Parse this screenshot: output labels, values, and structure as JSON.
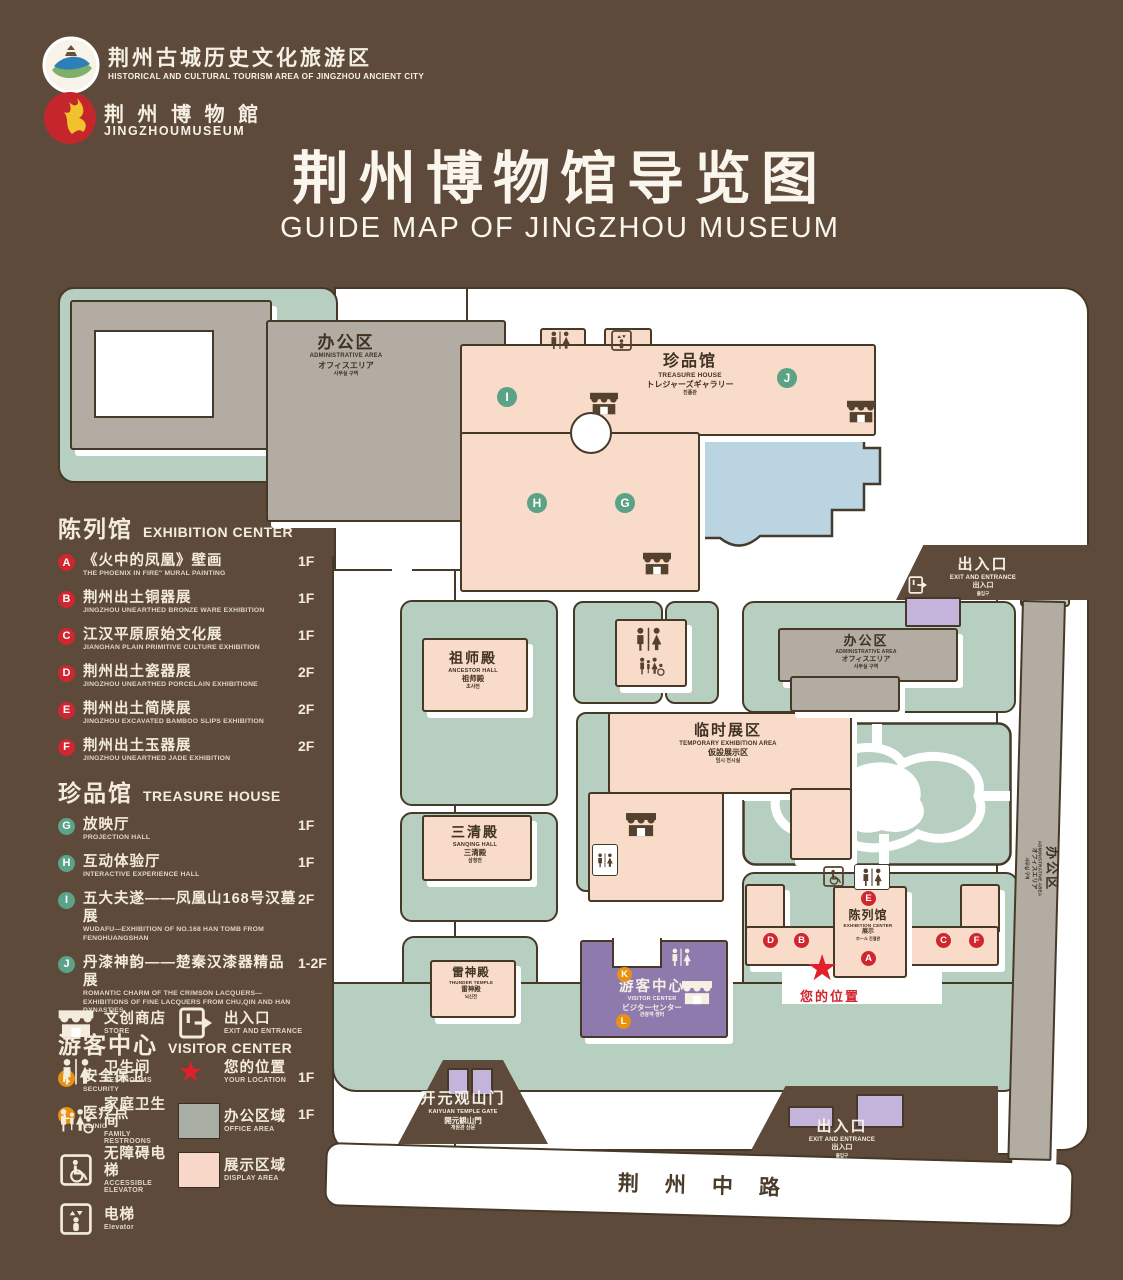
{
  "header": {
    "tourism_logo": {
      "cn": "荆州古城历史文化旅游区",
      "en": "HISTORICAL AND CULTURAL TOURISM AREA OF JINGZHOU ANCIENT CITY"
    },
    "museum_logo": {
      "cn": "荆 州 博 物 館",
      "en": "JINGZHOUMUSEUM"
    },
    "title_cn": "荆州博物馆导览图",
    "title_en": "GUIDE MAP OF JINGZHOU MUSEUM"
  },
  "colors": {
    "background": "#5d4a3a",
    "lawn_green": "#b7cfc1",
    "display_pink": "#f8dbc9",
    "office_gray": "#b2aca3",
    "pond_blue": "#bad4e2",
    "visitor_purple": "#8e7aac",
    "gate_purple": "#c4b3da",
    "badge_red": "#cf2630",
    "badge_green": "#5ba287",
    "badge_orange": "#e89112",
    "star_red": "#e0212b"
  },
  "legend": {
    "sections": [
      {
        "cn": "陈列馆",
        "en": "EXHIBITION CENTER",
        "badge_color": "#cf2630",
        "items": [
          {
            "key": "A",
            "cn": "《火中的凤凰》壁画",
            "en": "THE PHOENIX IN FIRE\" MURAL PAINTING",
            "floor": "1F"
          },
          {
            "key": "B",
            "cn": "荆州出土铜器展",
            "en": "JINGZHOU UNEARTHED BRONZE WARE EXHIBITION",
            "floor": "1F"
          },
          {
            "key": "C",
            "cn": "江汉平原原始文化展",
            "en": "JIANGHAN PLAIN PRIMITIVE CULTURE EXHIBITION",
            "floor": "1F"
          },
          {
            "key": "D",
            "cn": "荆州出土瓷器展",
            "en": "JINGZHOU UNEARTHED PORCELAIN EXHIBITIONE",
            "floor": "2F"
          },
          {
            "key": "E",
            "cn": "荆州出土简牍展",
            "en": "JINGZHOU EXCAVATED BAMBOO SLIPS EXHIBITION",
            "floor": "2F"
          },
          {
            "key": "F",
            "cn": "荆州出土玉器展",
            "en": "JINGZHOU UNEARTHED JADE EXHIBITION",
            "floor": "2F"
          }
        ]
      },
      {
        "cn": "珍品馆",
        "en": "TREASURE HOUSE",
        "badge_color": "#5ba287",
        "items": [
          {
            "key": "G",
            "cn": "放映厅",
            "en": "PROJECTION HALL",
            "floor": "1F"
          },
          {
            "key": "H",
            "cn": "互动体验厅",
            "en": "INTERACTIVE EXPERIENCE HALL",
            "floor": "1F"
          },
          {
            "key": "I",
            "cn": "五大夫遂——凤凰山168号汉墓展",
            "en": "WUDAFU—EXHIBITION OF NO.168 HAN TOMB FROM FENGHUANGSHAN",
            "floor": "2F"
          },
          {
            "key": "J",
            "cn": "丹漆神韵——楚秦汉漆器精品展",
            "en": "ROMANTIC CHARM OF THE CRIMSON LACQUERS—EXHIBITIONS OF FINE LACQUERS FROM CHU,QIN AND HAN DYNASTIES",
            "floor": "1-2F"
          }
        ]
      },
      {
        "cn": "游客中心",
        "en": "VISITOR CENTER",
        "badge_color": "#e89112",
        "items": [
          {
            "key": "K",
            "cn": "安全保卫",
            "en": "SECURITY",
            "floor": "1F"
          },
          {
            "key": "L",
            "cn": "医疗点",
            "en": "CLINIC",
            "floor": "1F"
          }
        ]
      }
    ],
    "symbols": [
      {
        "kind": "shop",
        "name": "store-icon",
        "cn": "文创商店",
        "en": "STORE"
      },
      {
        "kind": "wc",
        "name": "restrooms-icon",
        "cn": "卫生间",
        "en": "RESTROOMS"
      },
      {
        "kind": "family",
        "name": "family-restroom-icon",
        "cn": "家庭卫生间",
        "en": "FAMILY RESTROONS"
      },
      {
        "kind": "acc",
        "name": "accessible-elevator-icon",
        "cn": "无障碍电梯",
        "en": "ACCESSIBLE  ELEVATOR"
      },
      {
        "kind": "elev",
        "name": "elevator-icon",
        "cn": "电梯",
        "en": "Elevator"
      },
      {
        "kind": "exit",
        "name": "exit-entrance-icon",
        "cn": "出入口",
        "en": "EXIT AND ENTRANCE"
      },
      {
        "kind": "star",
        "name": "your-location-icon",
        "cn": "您的位置",
        "en": "YOUR LOCATION"
      },
      {
        "kind": "swatch",
        "color": "#a9aea4",
        "name": "office-area-swatch",
        "cn": "办公区域",
        "en": "OFFICE AREA"
      },
      {
        "kind": "swatch",
        "color": "#f8d7c8",
        "name": "display-area-swatch",
        "cn": "展示区域",
        "en": "DISPLAY AREA"
      }
    ]
  },
  "map": {
    "buildings": {
      "admin_nw": {
        "cn": "办公区",
        "en": "ADMINISTRATIVE AREA",
        "jp": "オフィスエリア",
        "kr": "사무실 구역"
      },
      "treasure": {
        "cn": "珍品馆",
        "en": "TREASURE HOUSE",
        "jp": "トレジャーズギャラリー",
        "kr": "진품관"
      },
      "ancestor": {
        "cn": "祖师殿",
        "en": "ANCESTOR HALL",
        "jp": "祖师殿",
        "kr": "조사전"
      },
      "temporary": {
        "cn": "临时展区",
        "en": "TEMPORARY EXHIBITION AREA",
        "jp": "仮設展示区",
        "kr": "임시 전시실"
      },
      "sanqing": {
        "cn": "三清殿",
        "en": "SANQING HALL",
        "jp": "三清殿",
        "kr": "삼청전"
      },
      "admin_e": {
        "cn": "办公区",
        "en": "ADMINISTRATIVE AREA",
        "jp": "オフィスエリア",
        "kr": "사무실 구역"
      },
      "admin_strip": {
        "cn": "办公区",
        "en": "ADMINISTRATIVE AREA",
        "jp": "オフィスエリア",
        "kr": "사무실 구역"
      },
      "thunder": {
        "cn": "雷神殿",
        "en": "THUNDER TEMPLE",
        "jp": "雷神殿",
        "kr": "뇌신전"
      },
      "exhibition": {
        "cn": "陈列馆",
        "en": "EXHIBITION CENTER",
        "jp": "展示",
        "kr": "ホール 진열관"
      },
      "visitor": {
        "cn": "游客中心",
        "en": "VISITOR CENTER",
        "jp": "ビジターセンター",
        "kr": "관광객 센터"
      },
      "gate": {
        "cn": "开元观山门",
        "en": "KAIYUAN TEMPLE GATE",
        "jp": "開元観山門",
        "kr": "개원관 산문"
      },
      "exit_ne": {
        "cn": "出入口",
        "en": "EXIT AND ENTRANCE",
        "jp": "出入口",
        "kr": "출입구"
      },
      "exit_se": {
        "cn": "出入口",
        "en": "EXIT AND ENTRANCE",
        "jp": "出入口",
        "kr": "출입구"
      },
      "road": {
        "cn": "荆州中路"
      }
    },
    "your_location": "您的位置",
    "badges": {
      "a": "A",
      "b": "B",
      "c": "C",
      "d": "D",
      "e": "E",
      "f": "F",
      "g": "G",
      "h": "H",
      "i": "I",
      "j": "J",
      "k": "K",
      "l": "L"
    }
  }
}
